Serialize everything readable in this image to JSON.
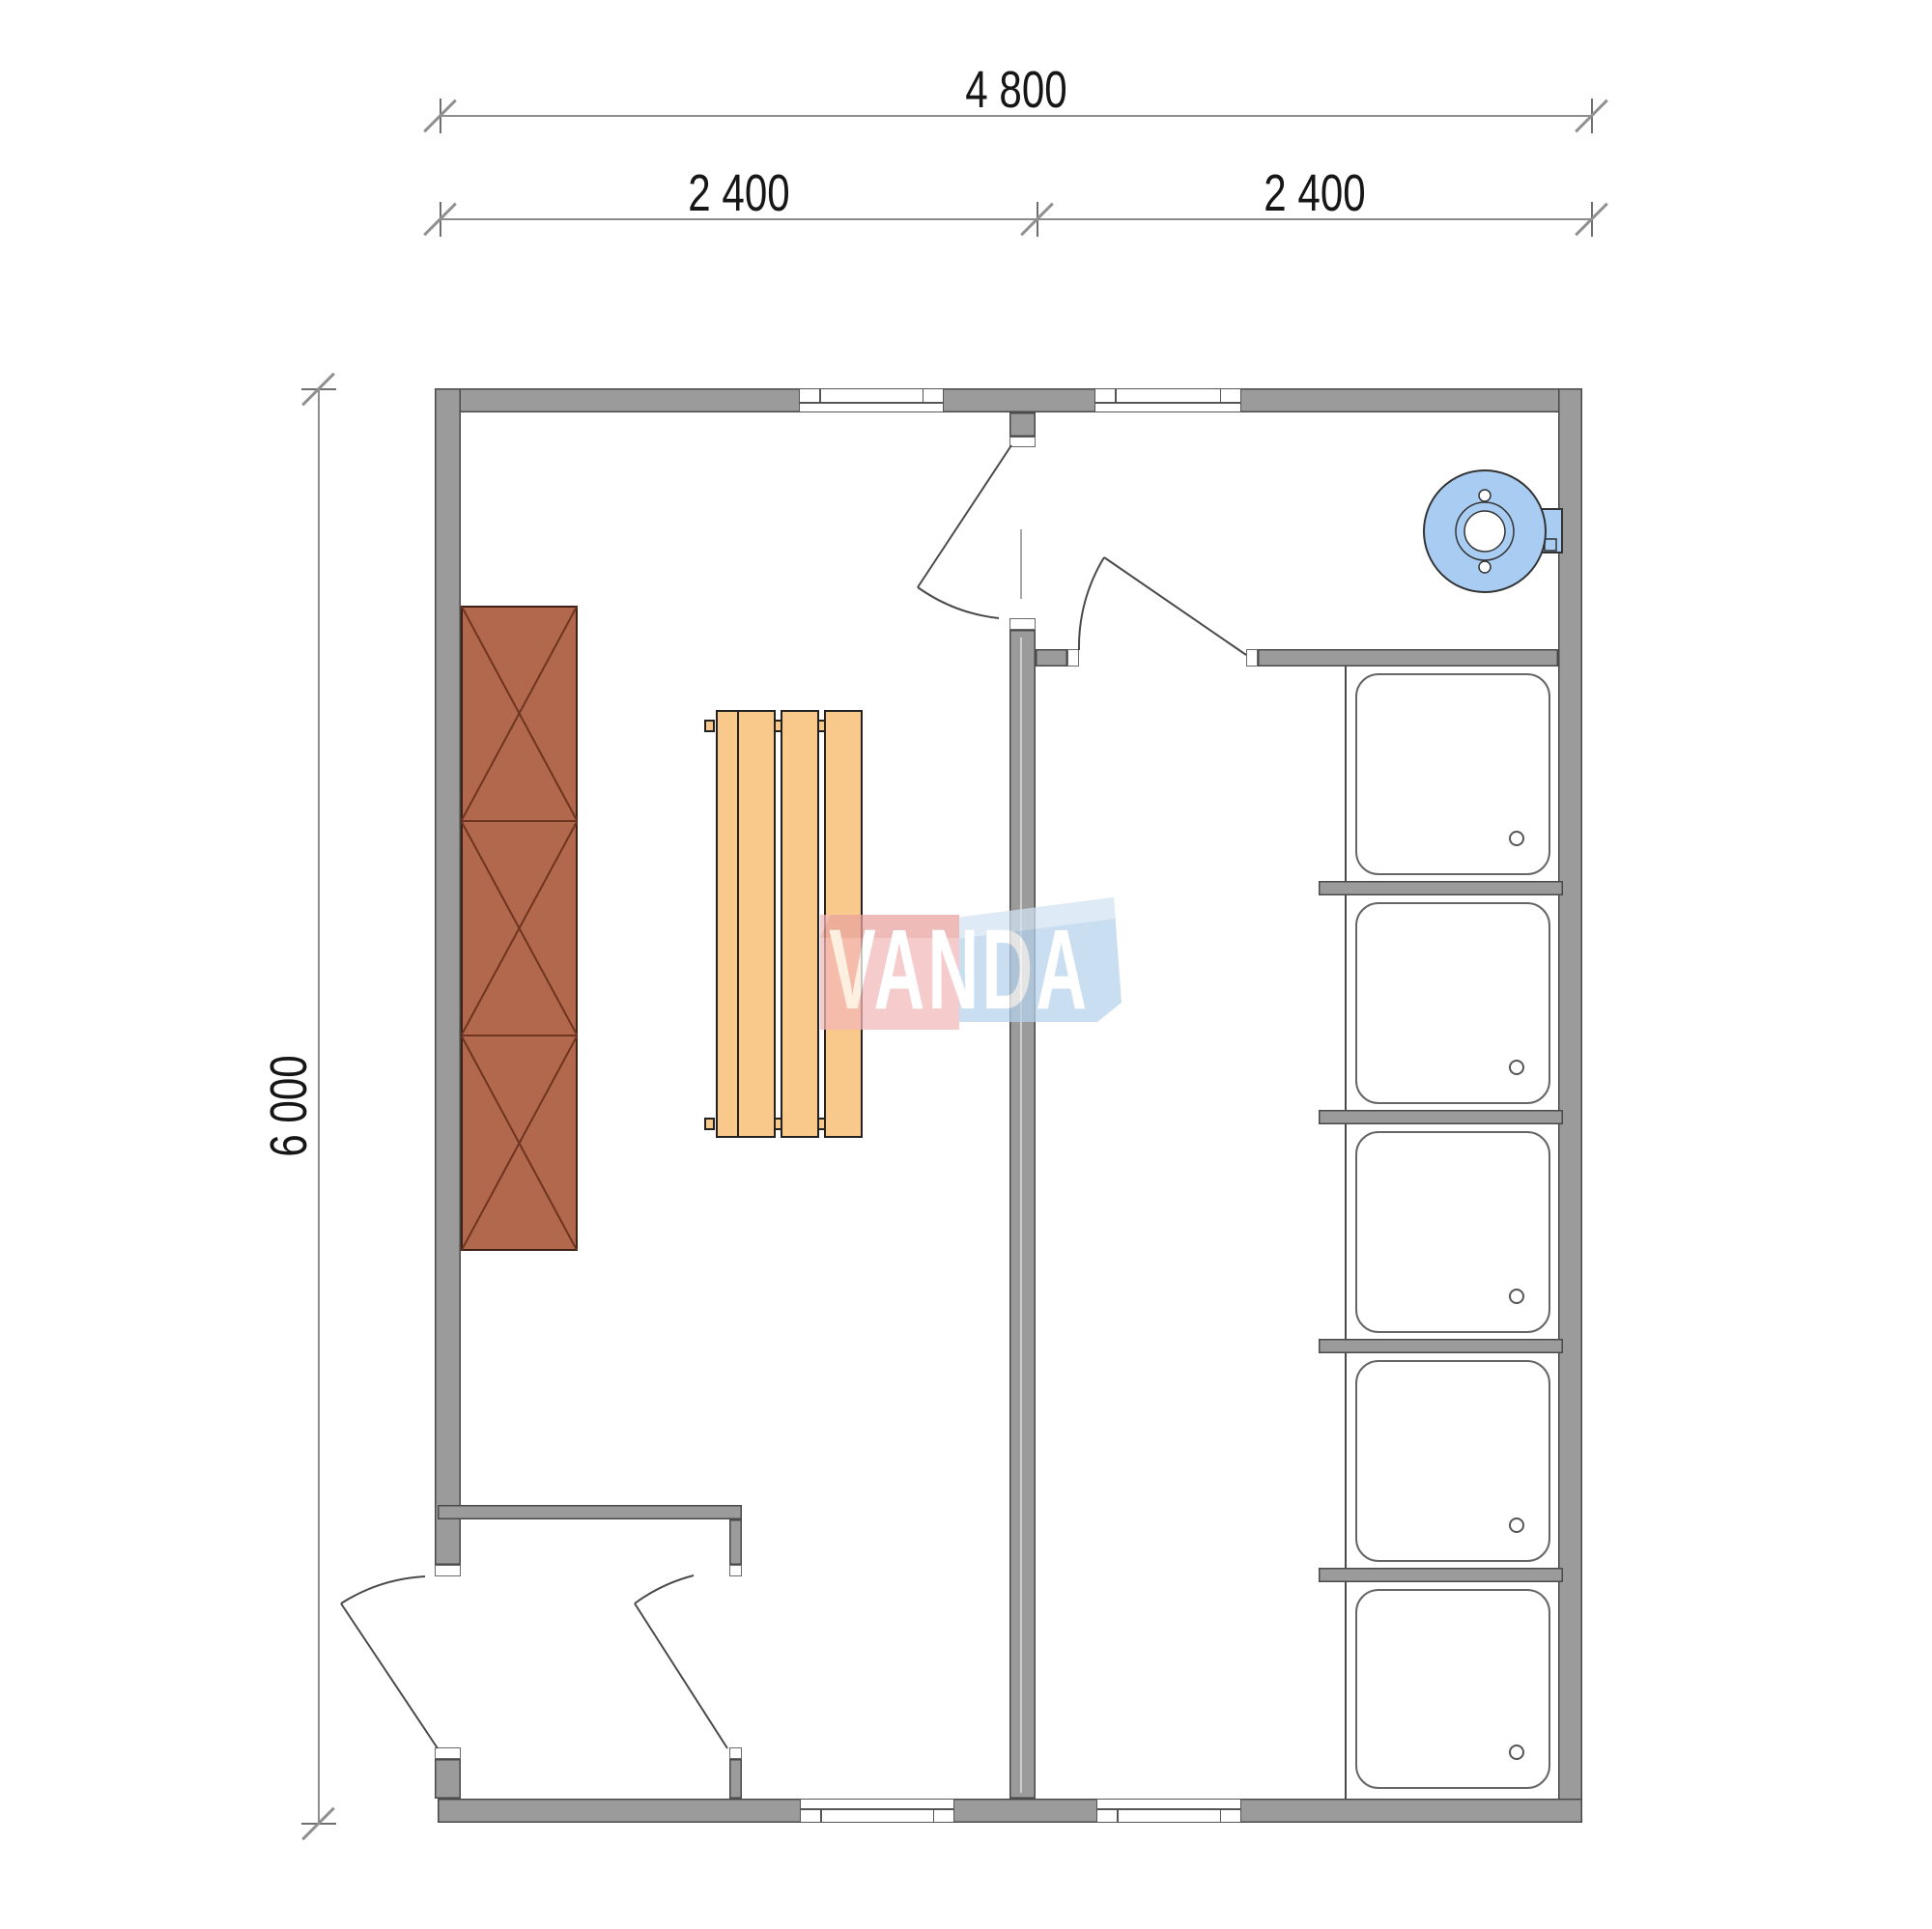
{
  "dimensions": {
    "total_width": "4 800",
    "span_left": "2 400",
    "span_right": "2 400",
    "total_height": "6 000"
  },
  "watermark": {
    "text": "VANDA"
  },
  "fixtures": {
    "shower_tray_count": 5,
    "icons": [
      "water-heater-icon",
      "shower-tray-icon",
      "bench-icon",
      "cabinet-icon",
      "door-swing-icon",
      "window-icon"
    ]
  },
  "colors": {
    "wall": "#9b9b9b",
    "wall_edge": "#4a4a4a",
    "cabinet_fill": "#b2684c",
    "cabinet_line": "#6e3420",
    "bench_fill": "#f9c98c",
    "boiler_fill": "#a9cdf2",
    "tray_edge": "#666666",
    "logo_red": "#f4b8b8",
    "logo_red_top": "#e8a39e",
    "logo_blue": "#b7d3ed",
    "logo_blue_top": "#d2e4f3",
    "dim_text": "#161616"
  }
}
